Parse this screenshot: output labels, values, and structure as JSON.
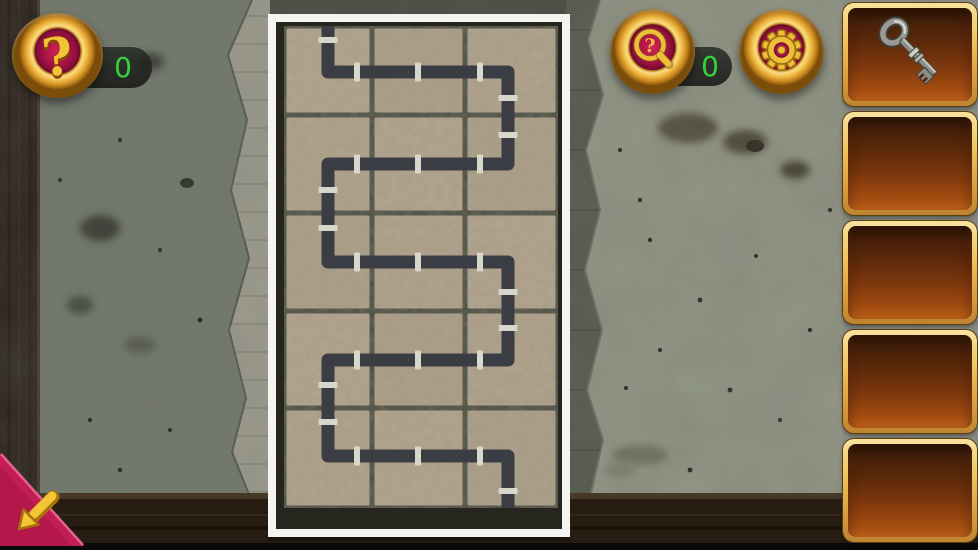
{
  "hud": {
    "help": {
      "icon": "question-mark",
      "count": "0"
    },
    "hint": {
      "icon": "magnifier-question",
      "count": "0"
    },
    "settings": {
      "icon": "gear"
    },
    "back": {
      "icon": "arrow-down-left"
    }
  },
  "inventory": {
    "slots": [
      {
        "index": 0,
        "item": "key"
      },
      {
        "index": 1,
        "item": null
      },
      {
        "index": 2,
        "item": null
      },
      {
        "index": 3,
        "item": null
      },
      {
        "index": 4,
        "item": null
      }
    ]
  },
  "puzzle": {
    "type": "pipe-maze",
    "grid": {
      "cols": 3,
      "rows": 5
    },
    "frame": {
      "x": 268,
      "y": 14,
      "width": 302,
      "height": 523
    },
    "tile_area": {
      "x": 16,
      "y": 12,
      "width": 274,
      "height": 482
    },
    "col_edges": [
      16,
      104,
      197,
      290
    ],
    "row_edges": [
      12,
      101,
      199,
      297,
      394,
      494
    ],
    "pipe_path": [
      [
        60,
        12
      ],
      [
        60,
        58
      ],
      [
        240,
        58
      ],
      [
        240,
        150
      ],
      [
        60,
        150
      ],
      [
        60,
        248
      ],
      [
        240,
        248
      ],
      [
        240,
        346
      ],
      [
        60,
        346
      ],
      [
        60,
        442
      ],
      [
        240,
        442
      ],
      [
        240,
        494
      ]
    ],
    "couplings": [
      [
        60,
        26,
        "v"
      ],
      [
        89,
        58,
        "h"
      ],
      [
        150,
        58,
        "h"
      ],
      [
        212,
        58,
        "h"
      ],
      [
        240,
        84,
        "v"
      ],
      [
        240,
        121,
        "v"
      ],
      [
        212,
        150,
        "h"
      ],
      [
        150,
        150,
        "h"
      ],
      [
        89,
        150,
        "h"
      ],
      [
        60,
        176,
        "v"
      ],
      [
        60,
        214,
        "v"
      ],
      [
        89,
        248,
        "h"
      ],
      [
        150,
        248,
        "h"
      ],
      [
        212,
        248,
        "h"
      ],
      [
        240,
        278,
        "v"
      ],
      [
        240,
        314,
        "v"
      ],
      [
        212,
        346,
        "h"
      ],
      [
        150,
        346,
        "h"
      ],
      [
        89,
        346,
        "h"
      ],
      [
        60,
        371,
        "v"
      ],
      [
        60,
        408,
        "v"
      ],
      [
        89,
        442,
        "h"
      ],
      [
        150,
        442,
        "h"
      ],
      [
        212,
        442,
        "h"
      ],
      [
        240,
        477,
        "v"
      ]
    ],
    "colors": {
      "backing": "#26261f",
      "grout": "#4d5146",
      "tile": "#b2a58f",
      "pipe": "#3a3e44",
      "coupling": "#d7d7cb",
      "frame": "#f4f4f0"
    }
  }
}
